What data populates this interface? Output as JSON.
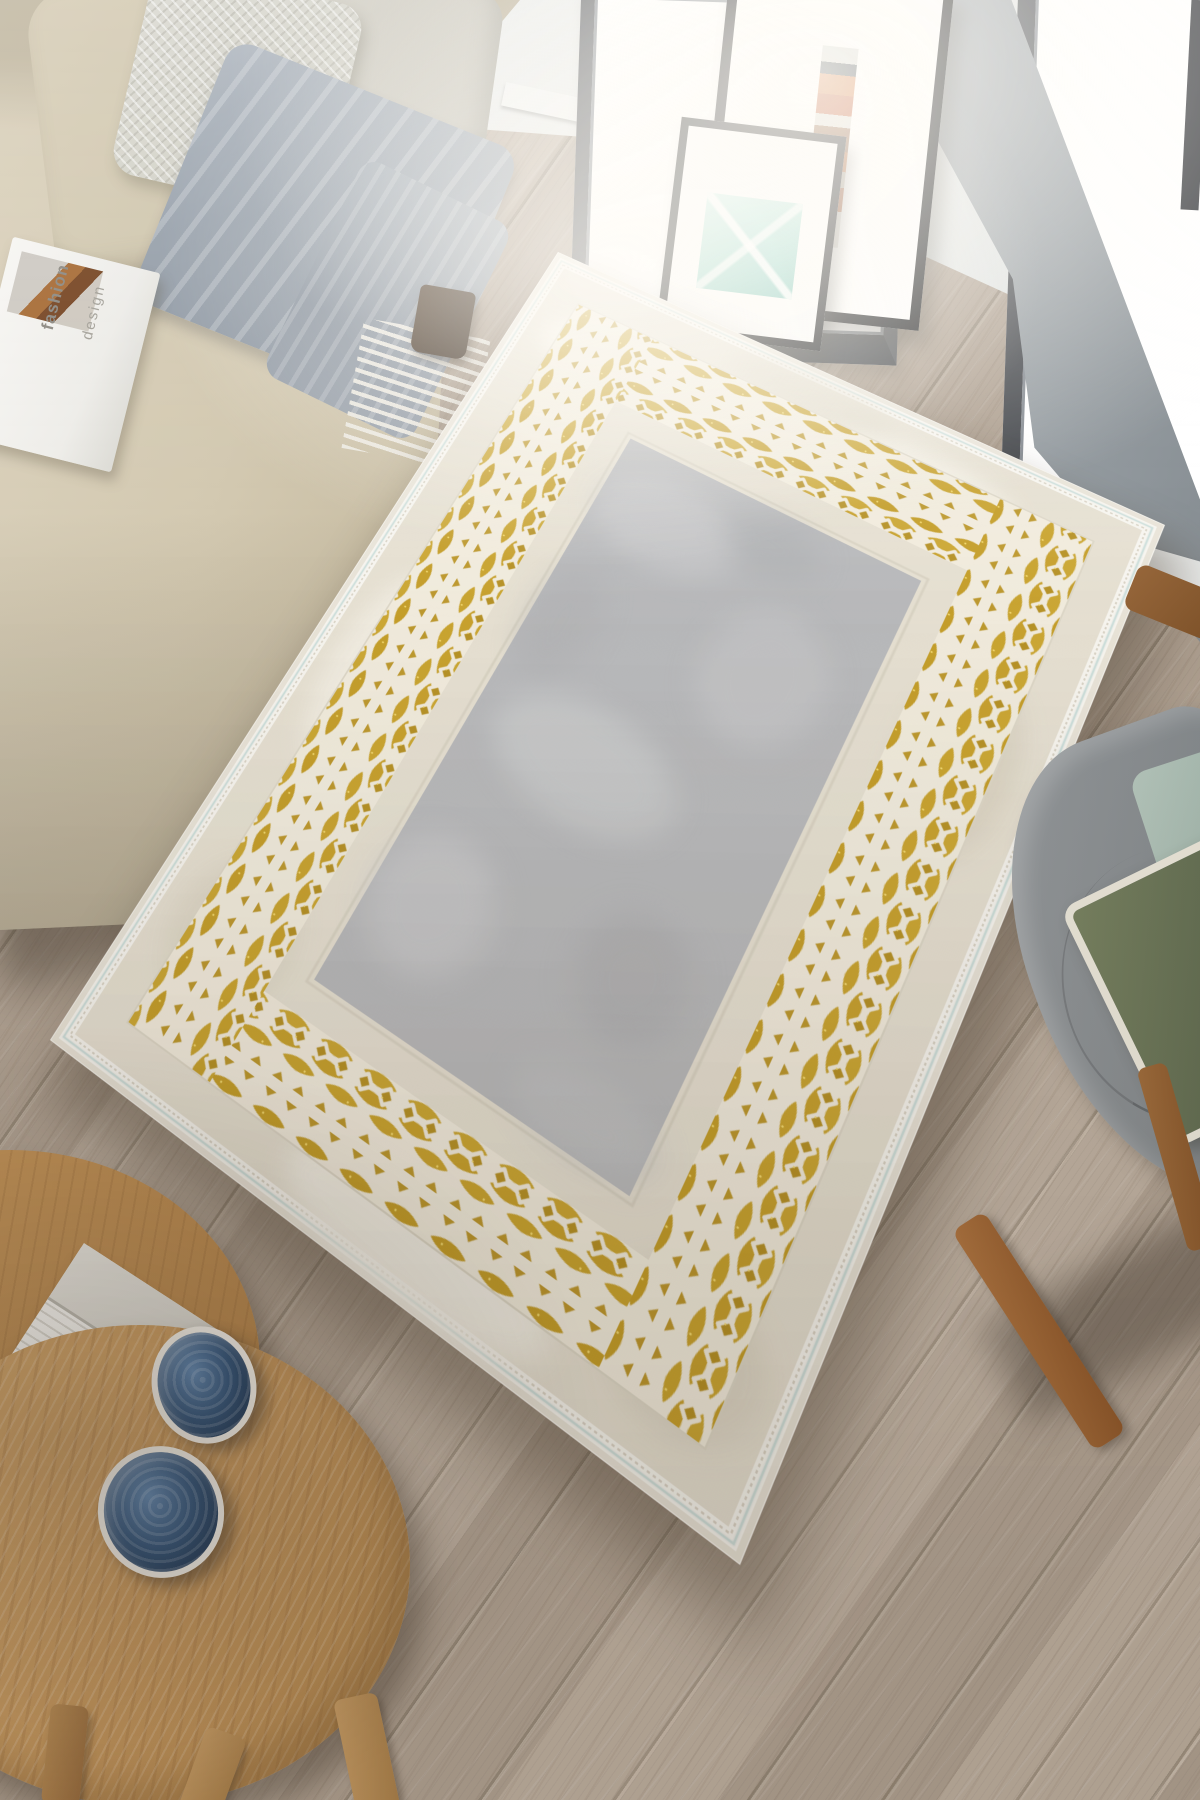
{
  "scene": {
    "type": "interior product photograph",
    "subject": "rectangular area rug with gold geometric lattice border and gray center on wooden floor",
    "room": "living room with beige sofa, floor-to-ceiling windows, leaning picture frames, round wooden side tables and gray armchair"
  },
  "magazine": {
    "lines": [
      "fashion",
      "design"
    ]
  },
  "rug": {
    "field_color": "#b6b7b9",
    "margin_color": "#e5dfd0",
    "gold_dark": "#b48e1e",
    "gold_mid": "#c39b22",
    "gold_light": "#caa42c",
    "lattice_color": "#f1ebdc",
    "selvage_color": "#f7f5ef",
    "sheen_color": "#cddfdb"
  },
  "palette": {
    "floor_plank": "#b7a898",
    "floor_seam": "#9d8f7e",
    "sofa_beige": "#d3c9b1",
    "throw_gray": "#9aa3ad",
    "fringe_white": "#ece9e1",
    "window_frame": "#4b4e53",
    "wall_pier_gray": "#979ea3",
    "frame_black": "#17181a",
    "art_teal": "#9fd9cd",
    "table_wood": "#c2945a",
    "bowl_blue": "#2e5076",
    "chair_gray": "#82878a",
    "cushion_green": "#5d684e",
    "cushion_piping": "#e7e3d6"
  },
  "objects": [
    "beige sofa with diamond-textured pillow and gray fringed throw blanket",
    "magazine on sofa arm",
    "two black leaning picture frames",
    "two floor-to-ceiling windows with dark frames",
    "gold and gray bordered rug",
    "round wooden nesting side tables",
    "stack of books on side table",
    "two blue ceramic bowls",
    "gray upholstered armchair with green piped cushion and wooden legs"
  ]
}
